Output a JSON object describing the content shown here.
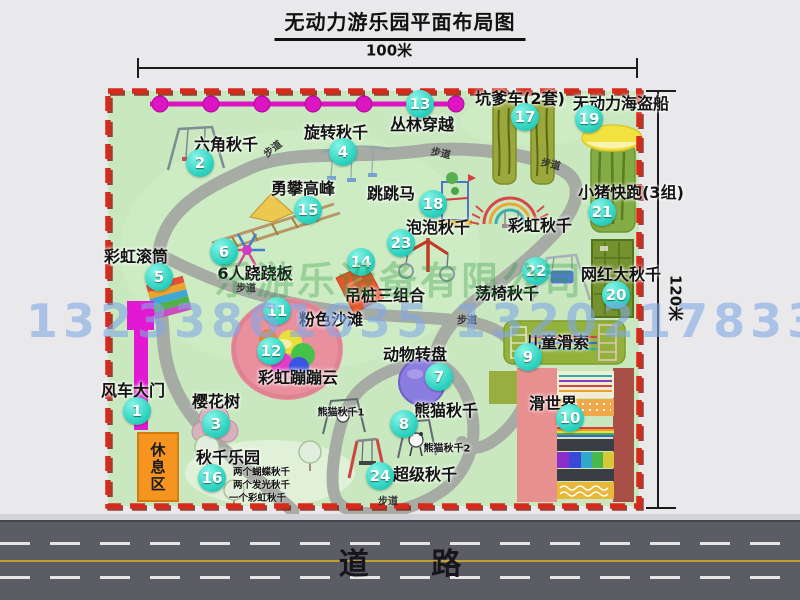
{
  "title": "无动力游乐园平面布局图",
  "dimensions": {
    "width_label": "100米",
    "height_label": "120米"
  },
  "road": {
    "label": "道 路"
  },
  "rest_area_label": "休息区",
  "path_label": "步道",
  "watermark": {
    "company": "乐游乐设备有限公司",
    "phones": "13233861635 13202178333"
  },
  "colors": {
    "park_green": "#c9e8bf",
    "border_red": "#d62a1c",
    "path_gray": "#a6aba4",
    "marker_cyan": "#2fd4c1",
    "road_gray": "#5c5c64",
    "gate_magenta": "#e318d2",
    "rest_orange": "#f5941e",
    "zipline_magenta": "#dd14c2",
    "pirate_yellow": "#f2e240"
  },
  "unnumbered_labels": [
    "彩虹秋千"
  ],
  "attractions": [
    {
      "num": "1",
      "label": "风车大门"
    },
    {
      "num": "2",
      "label": "六角秋千"
    },
    {
      "num": "3",
      "label": "樱花树"
    },
    {
      "num": "4",
      "label": "旋转秋千"
    },
    {
      "num": "5",
      "label": "彩虹滚筒"
    },
    {
      "num": "6",
      "label": "6人跷跷板"
    },
    {
      "num": "7",
      "label": "动物转盘"
    },
    {
      "num": "8",
      "label": "熊猫秋千",
      "sublabels": [
        "熊猫秋千1",
        "熊猫秋千2"
      ]
    },
    {
      "num": "9",
      "label": "儿童滑索"
    },
    {
      "num": "10",
      "label": "滑世界"
    },
    {
      "num": "11",
      "label": "粉色沙滩"
    },
    {
      "num": "12",
      "label": "彩虹蹦蹦云"
    },
    {
      "num": "13",
      "label": "丛林穿越"
    },
    {
      "num": "14",
      "label": "吊桩三组合"
    },
    {
      "num": "15",
      "label": "勇攀高峰"
    },
    {
      "num": "16",
      "label": "秋千乐园",
      "notes": [
        "两个蝴蝶秋千",
        "两个发光秋千",
        "一个彩虹秋千"
      ]
    },
    {
      "num": "17",
      "label": "坑爹车(2套)"
    },
    {
      "num": "18",
      "label": "跳跳马"
    },
    {
      "num": "19",
      "label": "无动力海盗船"
    },
    {
      "num": "20",
      "label": "网红大秋千"
    },
    {
      "num": "21",
      "label": "小猪快跑(3组)"
    },
    {
      "num": "22",
      "label": "荡椅秋千"
    },
    {
      "num": "23",
      "label": "泡泡秋千"
    },
    {
      "num": "24",
      "label": "超级秋千"
    }
  ]
}
